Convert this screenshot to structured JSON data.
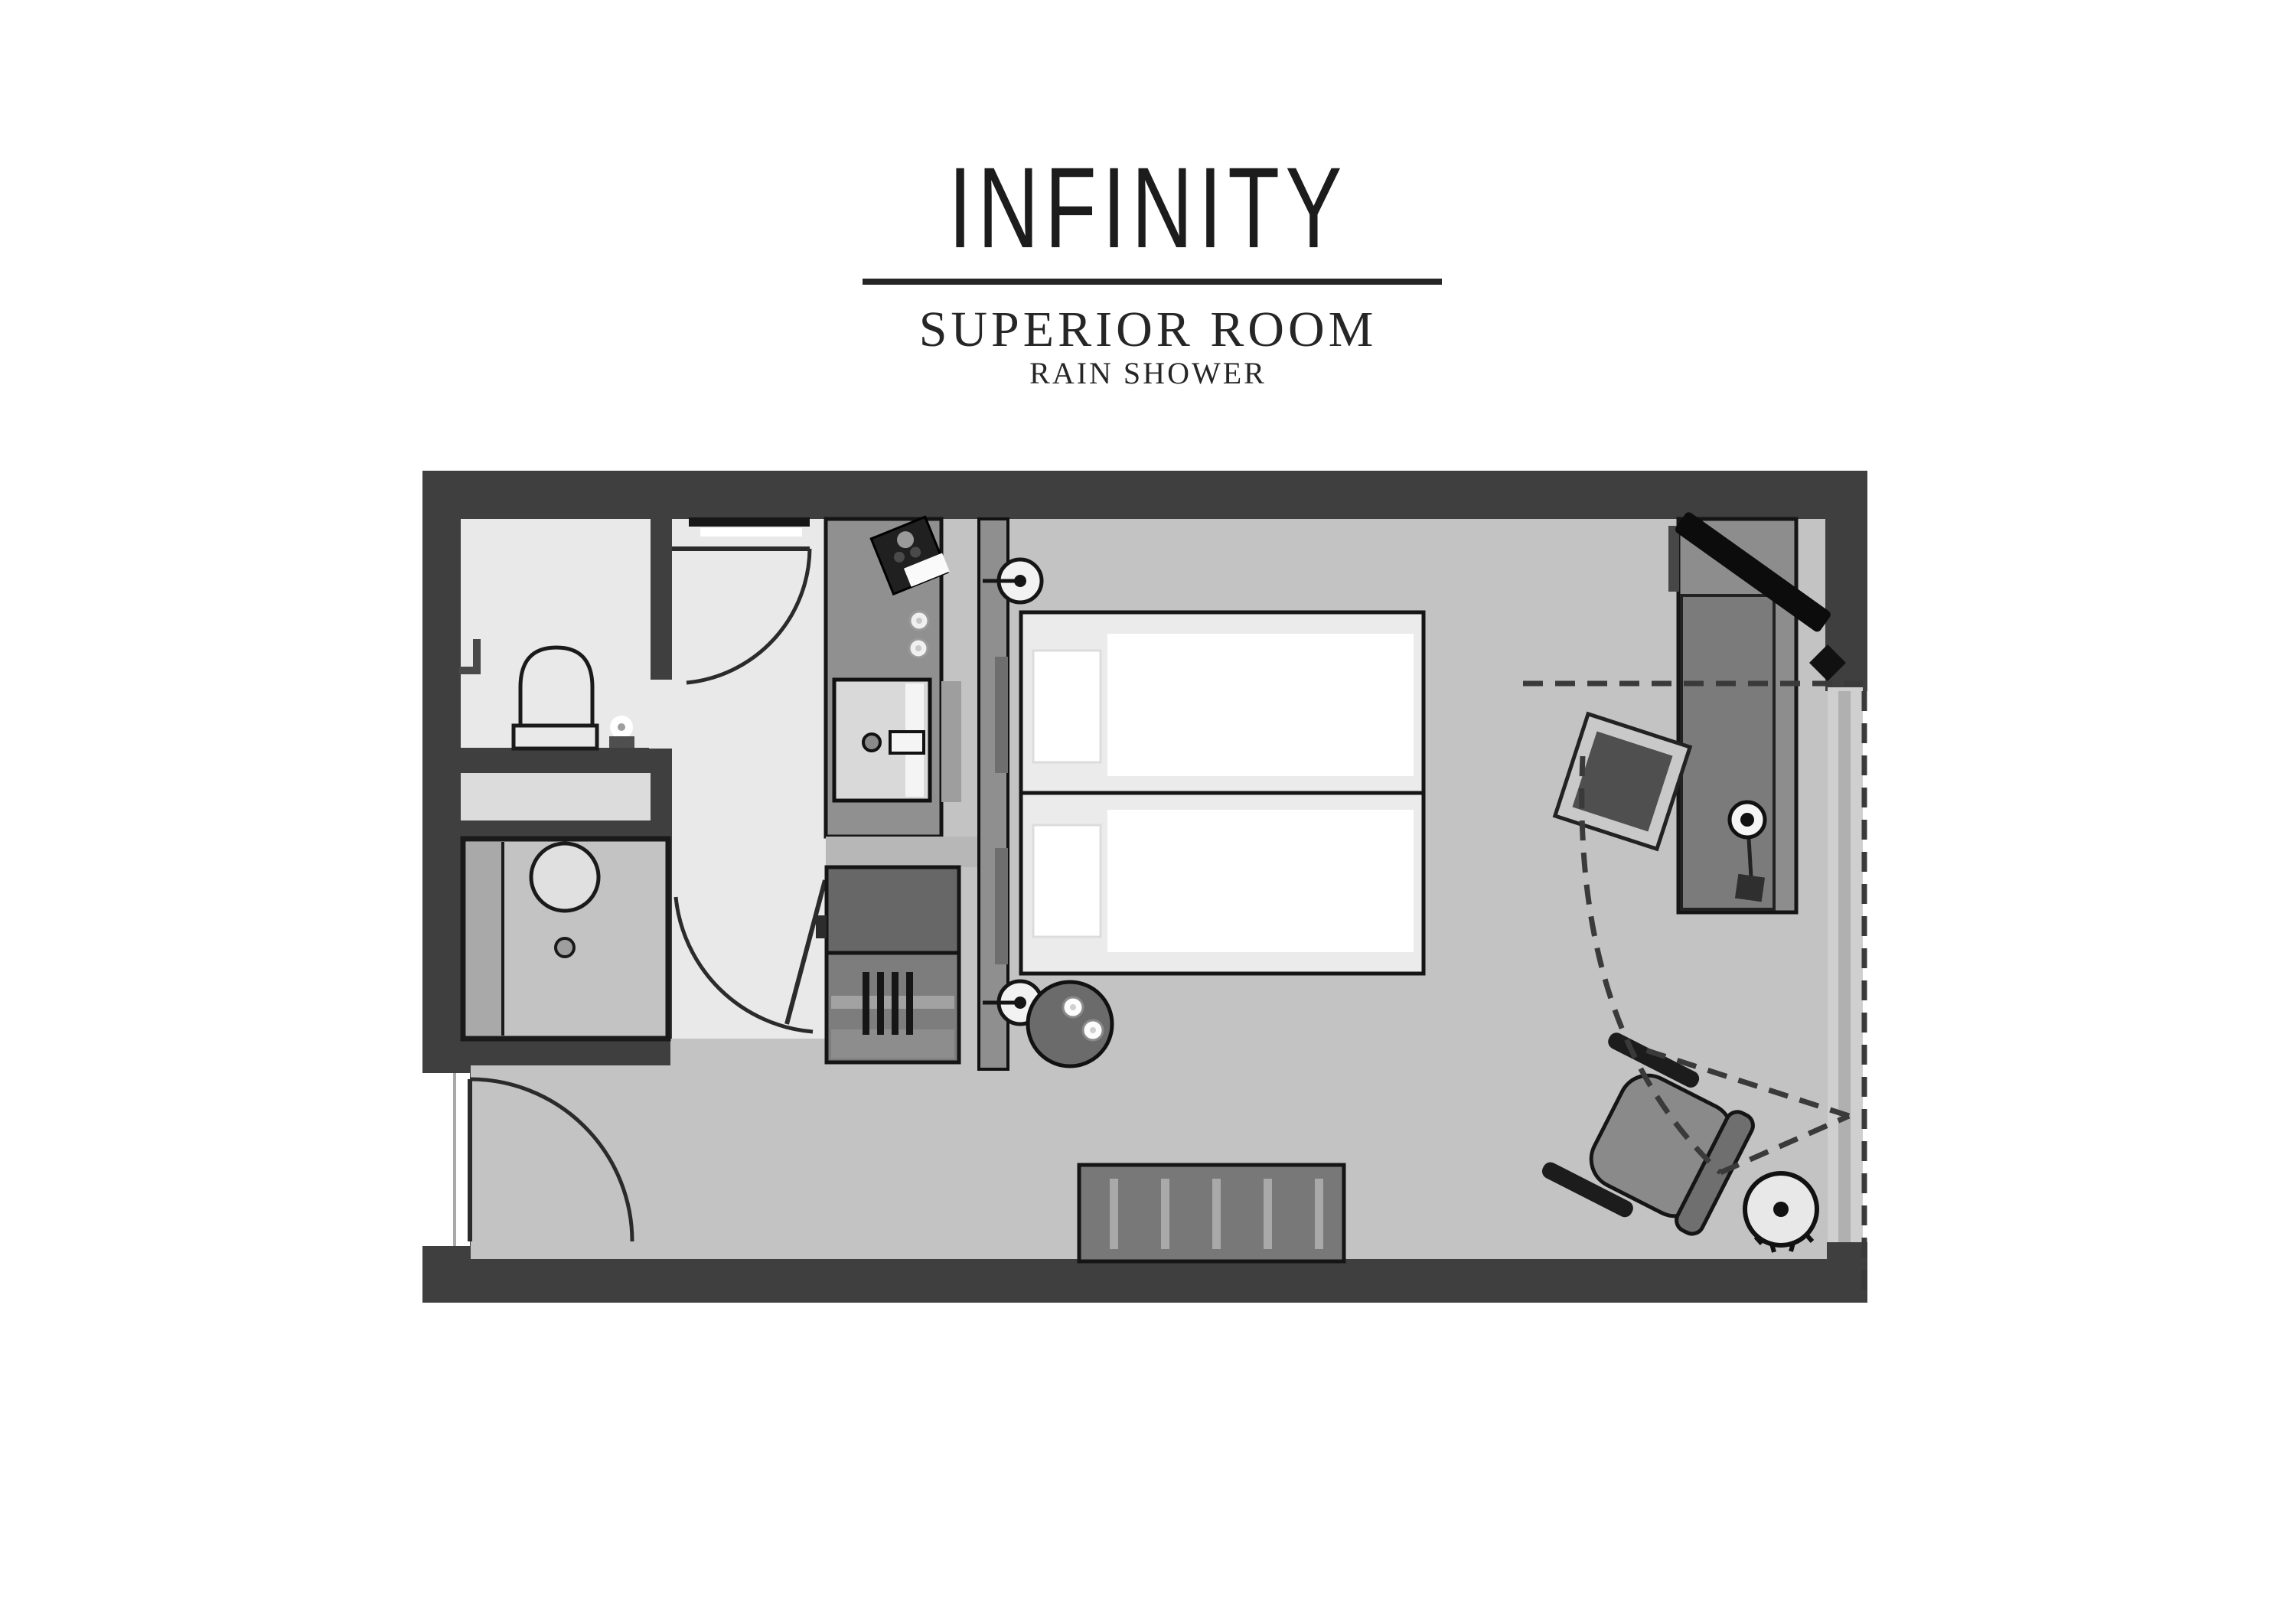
{
  "header": {
    "brand": "INFINITY",
    "room_type": "SUPERIOR ROOM",
    "room_feature": "RAIN SHOWER"
  },
  "palette": {
    "page_bg": "#ffffff",
    "wall": "#3f3f3f",
    "floor_main": "#c3c3c3",
    "floor_bath": "#e9e9e9",
    "floor_niche": "#dcdcdc",
    "glass": "#cfcfcf",
    "unit_light": "#909090",
    "unit_mid": "#7d7d7d",
    "unit_dark": "#676767",
    "bed_fill": "#ebebeb",
    "linen": "#ffffff",
    "tv_black": "#0c0c0c",
    "text": "#1c1c1c",
    "line_dark": "#1a1a1a",
    "dash_color": "#3a3a3a"
  }
}
